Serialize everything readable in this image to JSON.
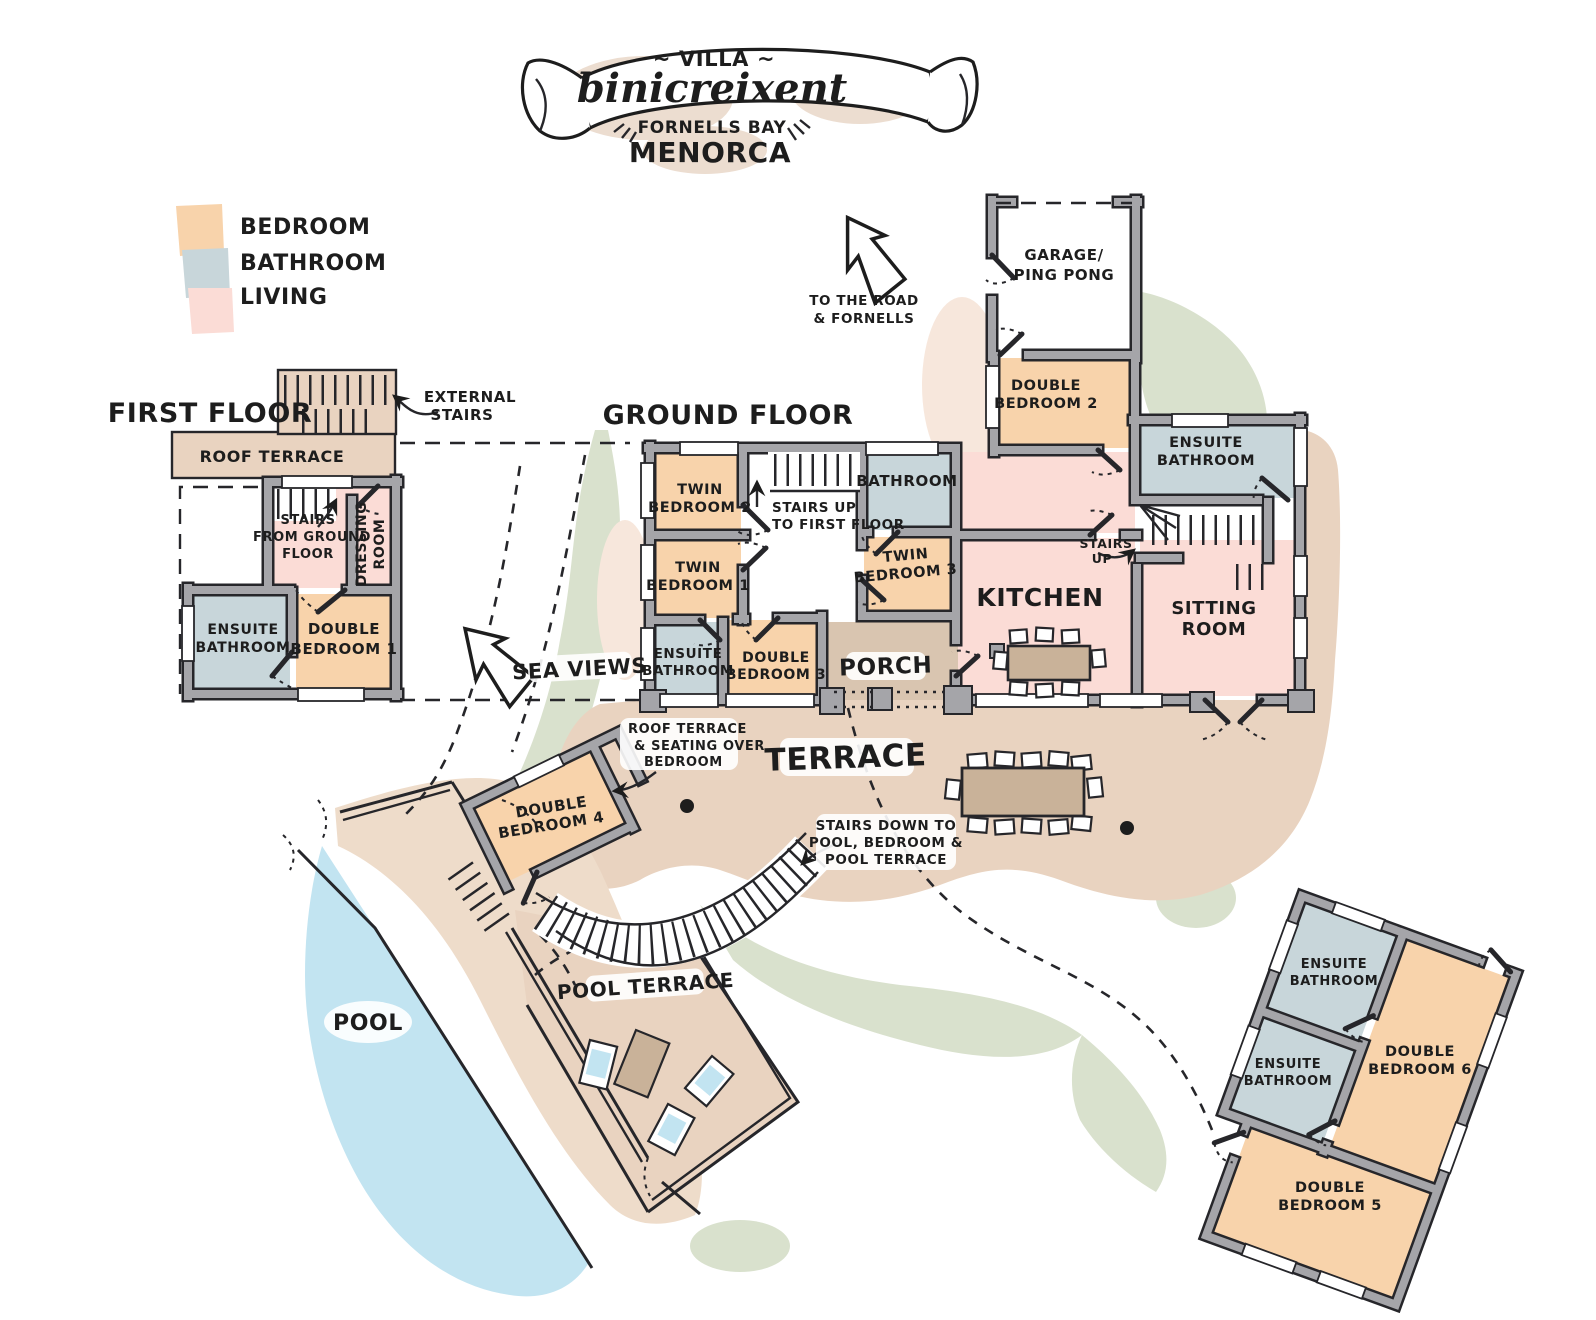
{
  "title": {
    "villa": "~ VILLA ~",
    "name": "binicreixent",
    "bay": "FORNELLS BAY",
    "island": "MENORCA"
  },
  "legend": {
    "items": [
      {
        "label": "BEDROOM",
        "color_key": "bedroom"
      },
      {
        "label": "BATHROOM",
        "color_key": "bathroom"
      },
      {
        "label": "LIVING",
        "color_key": "living"
      }
    ]
  },
  "floors": {
    "first": {
      "title": "FIRST FLOOR",
      "roof_terrace": "ROOF TERRACE",
      "external_stairs": [
        "EXTERNAL",
        "STAIRS"
      ],
      "stairs_from_ground": [
        "STAIRS",
        "FROM GROUND",
        "FLOOR"
      ],
      "dressing_room": [
        "DRESSING",
        "ROOM"
      ],
      "ensuite": [
        "ENSUITE",
        "BATHROOM"
      ],
      "double_bedroom_1": [
        "DOUBLE",
        "BEDROOM 1"
      ]
    },
    "ground": {
      "title": "GROUND FLOOR",
      "twin_bedroom_2": [
        "TWIN",
        "BEDROOM 2"
      ],
      "stairs_up_note": [
        "STAIRS UP",
        "TO FIRST FLOOR"
      ],
      "bathroom": "BATHROOM",
      "garage": [
        "GARAGE/",
        "PING PONG"
      ],
      "double_bedroom_2": [
        "DOUBLE",
        "BEDROOM 2"
      ],
      "ensuite_bathroom_right": [
        "ENSUITE",
        "BATHROOM"
      ],
      "twin_bedroom_1": [
        "TWIN",
        "BEDROOM 1"
      ],
      "twin_bedroom_3": [
        "TWIN",
        "BEDROOM 3"
      ],
      "kitchen": "KITCHEN",
      "stairs_up": [
        "STAIRS",
        "UP"
      ],
      "sitting_room": [
        "SITTING",
        "ROOM"
      ],
      "ensuite_bathroom_left": [
        "ENSUITE",
        "BATHROOM"
      ],
      "double_bedroom_3": [
        "DOUBLE",
        "BEDROOM 3"
      ],
      "porch": "PORCH"
    },
    "annex": {
      "ensuite_bathroom_top": [
        "ENSUITE",
        "BATHROOM"
      ],
      "ensuite_bathroom_left": [
        "ENSUITE",
        "BATHROOM"
      ],
      "double_bedroom_6": [
        "DOUBLE",
        "BEDROOM 6"
      ],
      "double_bedroom_5": [
        "DOUBLE",
        "BEDROOM 5"
      ]
    }
  },
  "outdoor": {
    "terrace": "TERRACE",
    "pool_terrace": "POOL TERRACE",
    "pool": "POOL",
    "sea_views": "SEA VIEWS",
    "to_the_road": [
      "TO THE ROAD",
      "& FORNELLS"
    ],
    "roof_terrace_note": [
      "ROOF TERRACE",
      "& SEATING OVER",
      "BEDROOM"
    ],
    "stairs_down_note": [
      "STAIRS DOWN TO",
      "POOL, BEDROOM &",
      "POOL TERRACE"
    ],
    "double_bedroom_4": [
      "DOUBLE",
      "BEDROOM 4"
    ]
  },
  "colors": {
    "bedroom": "#f8d3ab",
    "bathroom": "#c8d6da",
    "living": "#fbdcd6",
    "terrace": "#e9d3c0",
    "walkway": "#eedcca",
    "porch": "#d9c5b0",
    "pool": "#c2e4f1",
    "garden": "#d9e1cd",
    "garden_light": "#e4ecd6",
    "table": "#c9b299",
    "wall": "#a5a5a9",
    "ink": "#1d1d1d",
    "banner_shadow": "#ecddd0"
  }
}
